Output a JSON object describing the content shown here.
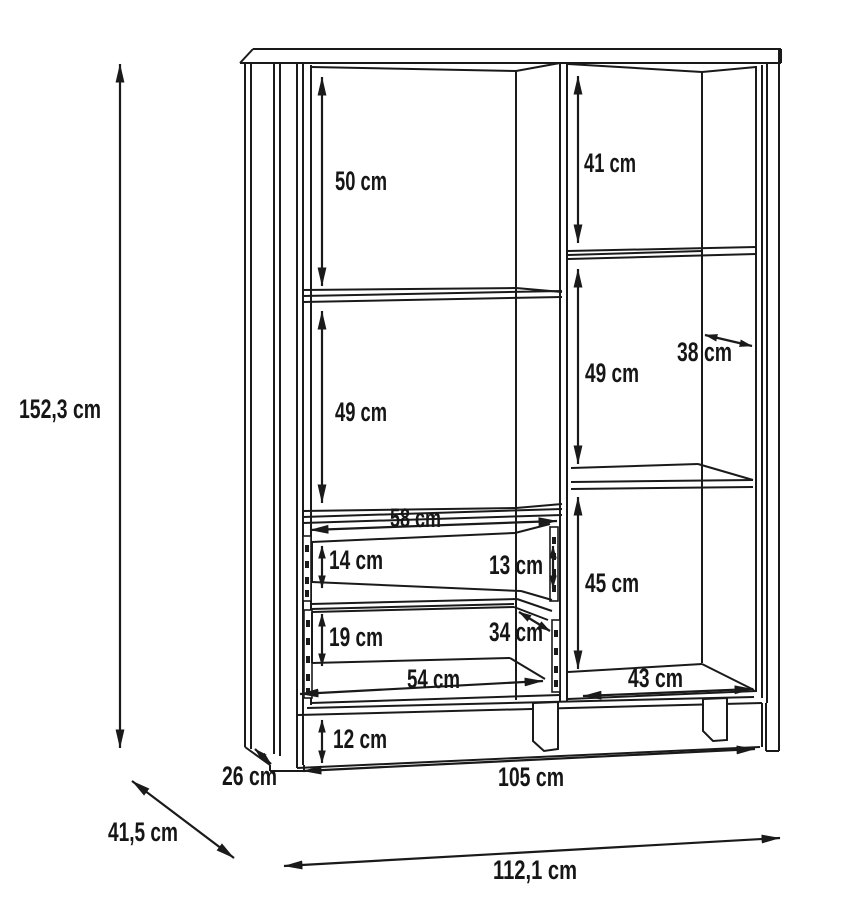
{
  "diagram": {
    "description": "Technical dimension drawing of a display cabinet with two drawers, shelves and plinth",
    "unit": "cm",
    "colors": {
      "line": "#1a1a1a",
      "background": "#ffffff",
      "text": "#161616"
    },
    "dims": {
      "overall_height": "152,3 cm",
      "overall_width": "112,1 cm",
      "overall_depth": "41,5 cm",
      "left_top_compartment": "50 cm",
      "left_middle_compartment": "49 cm",
      "left_inner_width": "58 cm",
      "top_drawer_front": "14 cm",
      "top_drawer_inner": "13 cm",
      "bottom_drawer_front": "19 cm",
      "drawer_inner_depth": "34 cm",
      "drawer_inner_width": "54 cm",
      "plinth_height": "12 cm",
      "plinth_width": "105 cm",
      "right_top_compartment": "41 cm",
      "right_middle_compartment": "49 cm",
      "right_inner_depth": "38 cm",
      "right_bottom_compartment": "45 cm",
      "right_inner_width": "43 cm",
      "foot_depth": "26 cm"
    }
  }
}
